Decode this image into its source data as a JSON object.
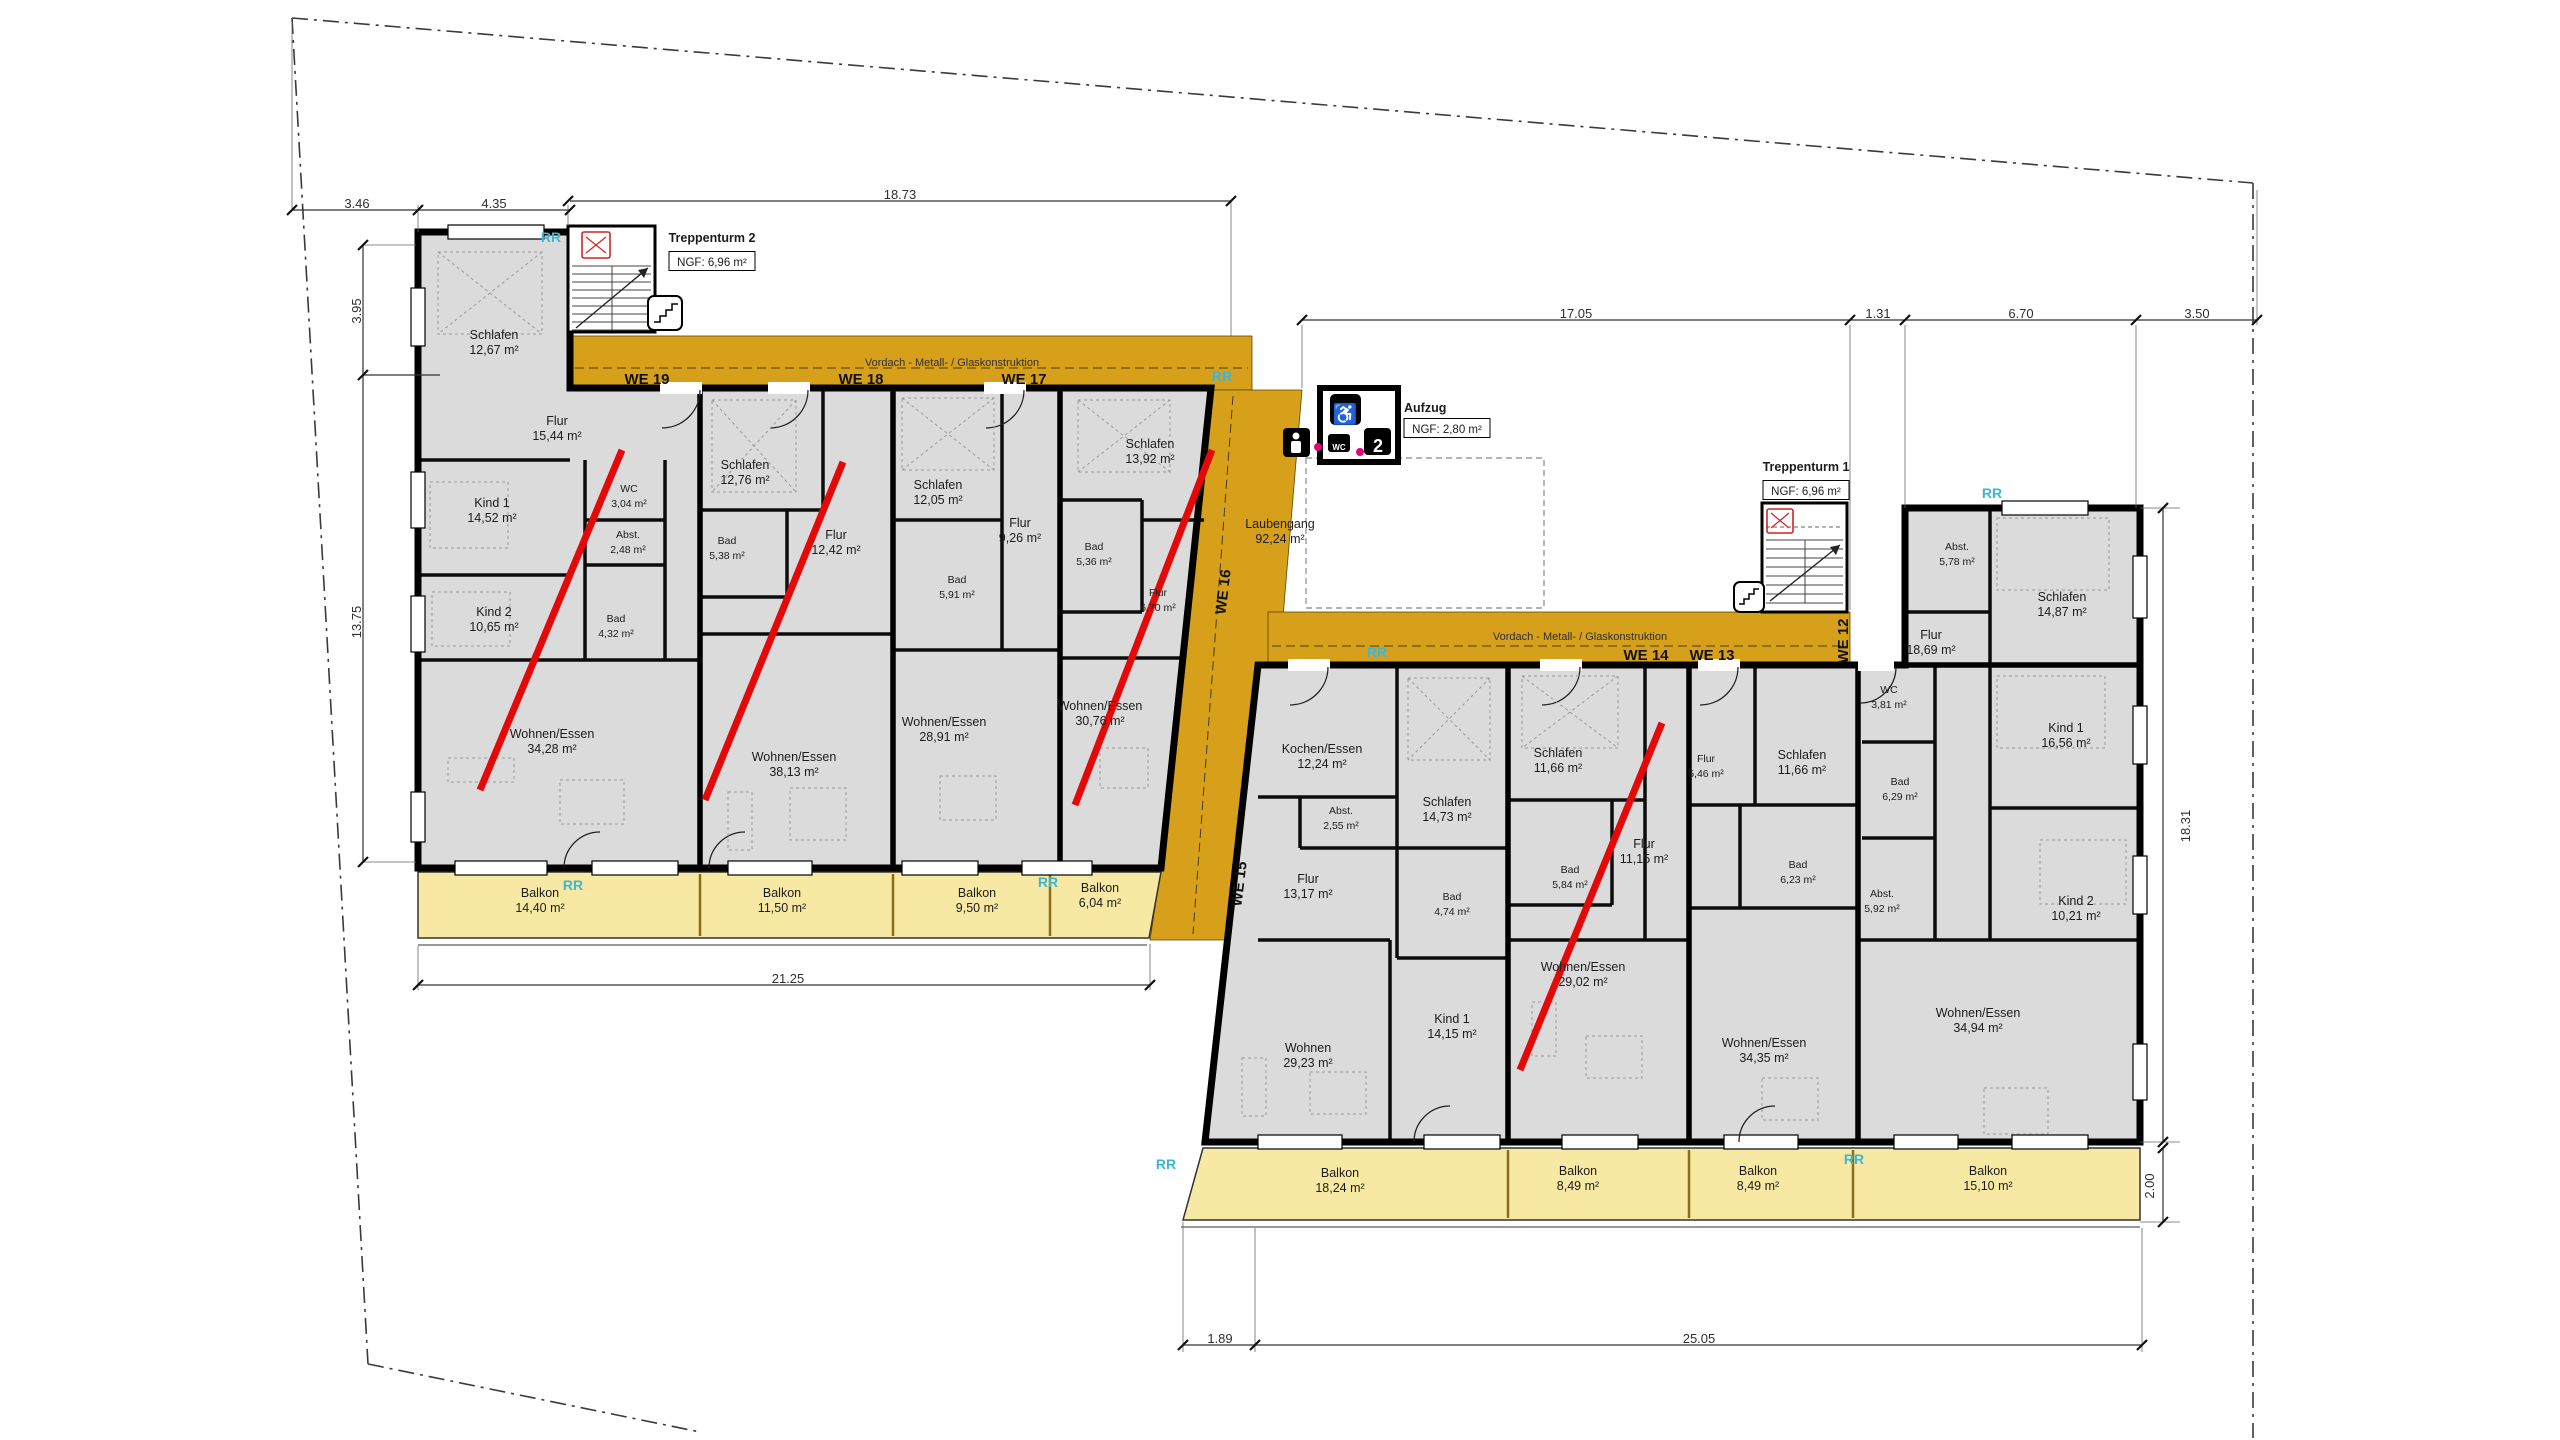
{
  "document": {
    "type": "architectural floor plan (Grundriss Obergeschoss)"
  },
  "colors": {
    "walkway_gold": "#D7A01B",
    "balcony_yellow": "#F7E8A3",
    "room_gray": "#DBDBDB",
    "marker_red": "#E50808",
    "rr_cyan": "#3AB7D8",
    "wall_black": "#000000"
  },
  "plan": {
    "labels": [
      {
        "k": "room",
        "unit": "WE 19",
        "t": [
          "Schlafen",
          "12,67 m²"
        ],
        "x": 494,
        "y": 341
      },
      {
        "k": "room",
        "unit": "WE 19",
        "t": [
          "Flur",
          "15,44 m²"
        ],
        "x": 557,
        "y": 427
      },
      {
        "k": "room",
        "unit": "WE 19",
        "t": [
          "Kind 1",
          "14,52 m²"
        ],
        "x": 492,
        "y": 509
      },
      {
        "k": "room small",
        "unit": "WE 19",
        "t": [
          "WC",
          "3,04 m²"
        ],
        "x": 629,
        "y": 494
      },
      {
        "k": "room small",
        "unit": "WE 19",
        "t": [
          "Abst.",
          "2,48 m²"
        ],
        "x": 628,
        "y": 540
      },
      {
        "k": "room",
        "unit": "WE 19",
        "t": [
          "Kind 2",
          "10,65 m²"
        ],
        "x": 494,
        "y": 618
      },
      {
        "k": "room small",
        "unit": "WE 19",
        "t": [
          "Bad",
          "4,32 m²"
        ],
        "x": 616,
        "y": 624
      },
      {
        "k": "room",
        "unit": "WE 19",
        "t": [
          "Wohnen/Essen",
          "34,28 m²"
        ],
        "x": 552,
        "y": 740
      },
      {
        "k": "room",
        "unit": "WE 19",
        "t": [
          "Balkon",
          "14,40 m²"
        ],
        "x": 540,
        "y": 899
      },
      {
        "k": "room",
        "unit": "WE 18",
        "t": [
          "Schlafen",
          "12,76 m²"
        ],
        "x": 745,
        "y": 471
      },
      {
        "k": "room small",
        "unit": "WE 18",
        "t": [
          "Bad",
          "5,38 m²"
        ],
        "x": 727,
        "y": 546
      },
      {
        "k": "room",
        "unit": "WE 18",
        "t": [
          "Flur",
          "12,42 m²"
        ],
        "x": 836,
        "y": 541
      },
      {
        "k": "room",
        "unit": "WE 18",
        "t": [
          "Wohnen/Essen",
          "38,13 m²"
        ],
        "x": 794,
        "y": 763
      },
      {
        "k": "room",
        "unit": "WE 18",
        "t": [
          "Balkon",
          "11,50 m²"
        ],
        "x": 782,
        "y": 899
      },
      {
        "k": "room",
        "unit": "WE 17",
        "t": [
          "Schlafen",
          "12,05 m²"
        ],
        "x": 938,
        "y": 491
      },
      {
        "k": "room",
        "unit": "WE 17",
        "t": [
          "Flur",
          "9,26 m²"
        ],
        "x": 1020,
        "y": 529
      },
      {
        "k": "room small",
        "unit": "WE 17",
        "t": [
          "Bad",
          "5,91 m²"
        ],
        "x": 957,
        "y": 585
      },
      {
        "k": "room",
        "unit": "WE 17",
        "t": [
          "Wohnen/Essen",
          "28,91 m²"
        ],
        "x": 944,
        "y": 728
      },
      {
        "k": "room",
        "unit": "WE 17",
        "t": [
          "Balkon",
          "9,50 m²"
        ],
        "x": 977,
        "y": 899
      },
      {
        "k": "room",
        "unit": "WE 16",
        "t": [
          "Schlafen",
          "13,92 m²"
        ],
        "x": 1150,
        "y": 450
      },
      {
        "k": "room small",
        "unit": "WE 16",
        "t": [
          "Bad",
          "5,36 m²"
        ],
        "x": 1094,
        "y": 552
      },
      {
        "k": "room small",
        "unit": "WE 16",
        "t": [
          "Flur",
          "6,70 m²"
        ],
        "x": 1158,
        "y": 598
      },
      {
        "k": "room",
        "unit": "WE 16",
        "t": [
          "Wohnen/Essen",
          "30,76 m²"
        ],
        "x": 1100,
        "y": 712
      },
      {
        "k": "room",
        "unit": "WE 16",
        "t": [
          "Balkon",
          "6,04 m²"
        ],
        "x": 1100,
        "y": 894
      },
      {
        "k": "room",
        "unit": "Laubengang",
        "t": [
          "Laubengang",
          "92,24 m²"
        ],
        "x": 1280,
        "y": 530
      },
      {
        "k": "room",
        "unit": "WE 15",
        "t": [
          "Kochen/Essen",
          "12,24 m²"
        ],
        "x": 1322,
        "y": 755
      },
      {
        "k": "room small",
        "unit": "WE 15",
        "t": [
          "Abst.",
          "2,55 m²"
        ],
        "x": 1341,
        "y": 816
      },
      {
        "k": "room",
        "unit": "WE 15",
        "t": [
          "Flur",
          "13,17 m²"
        ],
        "x": 1308,
        "y": 885
      },
      {
        "k": "room",
        "unit": "WE 15",
        "t": [
          "Schlafen",
          "14,73 m²"
        ],
        "x": 1447,
        "y": 808
      },
      {
        "k": "room small",
        "unit": "WE 15",
        "t": [
          "Bad",
          "4,74 m²"
        ],
        "x": 1452,
        "y": 902
      },
      {
        "k": "room",
        "unit": "WE 15",
        "t": [
          "Kind 1",
          "14,15 m²"
        ],
        "x": 1452,
        "y": 1025
      },
      {
        "k": "room",
        "unit": "WE 15",
        "t": [
          "Wohnen",
          "29,23 m²"
        ],
        "x": 1308,
        "y": 1054
      },
      {
        "k": "room",
        "unit": "WE 15",
        "t": [
          "Balkon",
          "18,24 m²"
        ],
        "x": 1340,
        "y": 1179
      },
      {
        "k": "room",
        "unit": "WE 14",
        "t": [
          "Schlafen",
          "11,66 m²"
        ],
        "x": 1558,
        "y": 759
      },
      {
        "k": "room small",
        "unit": "WE 14",
        "t": [
          "Bad",
          "5,84 m²"
        ],
        "x": 1570,
        "y": 875
      },
      {
        "k": "room",
        "unit": "WE 14",
        "t": [
          "Flur",
          "11,15 m²"
        ],
        "x": 1644,
        "y": 850
      },
      {
        "k": "room",
        "unit": "WE 14",
        "t": [
          "Wohnen/Essen",
          "29,02 m²"
        ],
        "x": 1583,
        "y": 973
      },
      {
        "k": "room",
        "unit": "WE 14",
        "t": [
          "Balkon",
          "8,49 m²"
        ],
        "x": 1578,
        "y": 1177
      },
      {
        "k": "room small",
        "unit": "WE 13",
        "t": [
          "Flur",
          "5,46 m²"
        ],
        "x": 1706,
        "y": 764
      },
      {
        "k": "room",
        "unit": "WE 13",
        "t": [
          "Schlafen",
          "11,66 m²"
        ],
        "x": 1802,
        "y": 761
      },
      {
        "k": "room small",
        "unit": "WE 13",
        "t": [
          "Bad",
          "6,23 m²"
        ],
        "x": 1798,
        "y": 870
      },
      {
        "k": "room",
        "unit": "WE 13",
        "t": [
          "Wohnen/Essen",
          "34,35 m²"
        ],
        "x": 1764,
        "y": 1049
      },
      {
        "k": "room",
        "unit": "WE 13",
        "t": [
          "Balkon",
          "8,49 m²"
        ],
        "x": 1758,
        "y": 1177
      },
      {
        "k": "room small",
        "unit": "WE 12",
        "t": [
          "WC",
          "3,81 m²"
        ],
        "x": 1889,
        "y": 695
      },
      {
        "k": "room small",
        "unit": "WE 12",
        "t": [
          "Bad",
          "6,29 m²"
        ],
        "x": 1900,
        "y": 787
      },
      {
        "k": "room small",
        "unit": "WE 12",
        "t": [
          "Abst.",
          "5,92 m²"
        ],
        "x": 1882,
        "y": 899
      },
      {
        "k": "room small",
        "unit": "WE 12",
        "t": [
          "Abst.",
          "5,78 m²"
        ],
        "x": 1957,
        "y": 552
      },
      {
        "k": "room",
        "unit": "WE 12",
        "t": [
          "Schlafen",
          "14,87 m²"
        ],
        "x": 2062,
        "y": 603
      },
      {
        "k": "room",
        "unit": "WE 12",
        "t": [
          "Flur",
          "18,69 m²"
        ],
        "x": 1931,
        "y": 641
      },
      {
        "k": "room",
        "unit": "WE 12",
        "t": [
          "Kind 1",
          "16,56 m²"
        ],
        "x": 2066,
        "y": 734
      },
      {
        "k": "room",
        "unit": "WE 12",
        "t": [
          "Kind 2",
          "10,21 m²"
        ],
        "x": 2076,
        "y": 907
      },
      {
        "k": "room",
        "unit": "WE 12",
        "t": [
          "Wohnen/Essen",
          "34,94 m²"
        ],
        "x": 1978,
        "y": 1019
      },
      {
        "k": "room",
        "unit": "WE 12",
        "t": [
          "Balkon",
          "15,10 m²"
        ],
        "x": 1988,
        "y": 1177
      },
      {
        "k": "we",
        "n": "unit-label",
        "t": [
          "WE 19"
        ],
        "x": 647,
        "y": 380
      },
      {
        "k": "we",
        "n": "unit-label",
        "t": [
          "WE 18"
        ],
        "x": 861,
        "y": 380
      },
      {
        "k": "we",
        "n": "unit-label",
        "t": [
          "WE 17"
        ],
        "x": 1024,
        "y": 380
      },
      {
        "k": "we",
        "n": "unit-label",
        "t": [
          "WE 16"
        ],
        "x": 1224,
        "y": 592,
        "r": -83
      },
      {
        "k": "we",
        "n": "unit-label",
        "t": [
          "WE 15"
        ],
        "x": 1240,
        "y": 884,
        "r": -83
      },
      {
        "k": "we",
        "n": "unit-label",
        "t": [
          "WE 14"
        ],
        "x": 1646,
        "y": 656
      },
      {
        "k": "we",
        "n": "unit-label",
        "t": [
          "WE 13"
        ],
        "x": 1712,
        "y": 656
      },
      {
        "k": "we",
        "n": "unit-label",
        "t": [
          "WE 12"
        ],
        "x": 1844,
        "y": 641,
        "r": -90
      },
      {
        "k": "rr",
        "n": "rr-marker",
        "t": [
          "RR"
        ],
        "x": 551,
        "y": 238
      },
      {
        "k": "rr",
        "n": "rr-marker",
        "t": [
          "RR"
        ],
        "x": 1222,
        "y": 377
      },
      {
        "k": "rr",
        "n": "rr-marker",
        "t": [
          "RR"
        ],
        "x": 573,
        "y": 886
      },
      {
        "k": "rr",
        "n": "rr-marker",
        "t": [
          "RR"
        ],
        "x": 1048,
        "y": 883
      },
      {
        "k": "rr",
        "n": "rr-marker",
        "t": [
          "RR"
        ],
        "x": 1377,
        "y": 653
      },
      {
        "k": "rr",
        "n": "rr-marker",
        "t": [
          "RR"
        ],
        "x": 1992,
        "y": 494
      },
      {
        "k": "rr",
        "n": "rr-marker",
        "t": [
          "RR"
        ],
        "x": 1166,
        "y": 1165
      },
      {
        "k": "rr",
        "n": "rr-marker",
        "t": [
          "RR"
        ],
        "x": 1854,
        "y": 1160
      },
      {
        "k": "head",
        "n": "stair-tower-2-title",
        "t": [
          "Treppenturm 2"
        ],
        "x": 712,
        "y": 238
      },
      {
        "k": "ngf",
        "n": "stair-tower-2-area",
        "t": [
          "NGF: 6,96 m²"
        ],
        "x": 712,
        "y": 262,
        "box": [
          86,
          19
        ]
      },
      {
        "k": "head",
        "n": "stair-tower-1-title",
        "t": [
          "Treppenturm 1"
        ],
        "x": 1806,
        "y": 467
      },
      {
        "k": "ngf",
        "n": "stair-tower-1-area",
        "t": [
          "NGF: 6,96 m²"
        ],
        "x": 1806,
        "y": 491,
        "box": [
          86,
          19
        ]
      },
      {
        "k": "head",
        "n": "elevator-title",
        "t": [
          "Aufzug"
        ],
        "x": 1404,
        "y": 408,
        "a": "start"
      },
      {
        "k": "ngf",
        "n": "elevator-area",
        "t": [
          "NGF: 2,80 m²"
        ],
        "x": 1447,
        "y": 429,
        "box": [
          86,
          19
        ]
      },
      {
        "k": "vord",
        "n": "canopy-label",
        "t": [
          "Vordach - Metall- / Glaskonstruktion"
        ],
        "x": 952,
        "y": 362
      },
      {
        "k": "vord",
        "n": "canopy-label",
        "t": [
          "Vordach - Metall- / Glaskonstruktion"
        ],
        "x": 1580,
        "y": 636
      },
      {
        "k": "dim",
        "n": "dimension-label",
        "t": [
          "3.46"
        ],
        "x": 357,
        "y": 204
      },
      {
        "k": "dim",
        "n": "dimension-label",
        "t": [
          "4.35"
        ],
        "x": 494,
        "y": 204
      },
      {
        "k": "dim",
        "n": "dimension-label",
        "t": [
          "18.73"
        ],
        "x": 900,
        "y": 195
      },
      {
        "k": "dim",
        "n": "dimension-label",
        "t": [
          "3.95"
        ],
        "x": 357,
        "y": 311,
        "r": -90
      },
      {
        "k": "dim",
        "n": "dimension-label",
        "t": [
          "13.75"
        ],
        "x": 357,
        "y": 622,
        "r": -90
      },
      {
        "k": "dim",
        "n": "dimension-label",
        "t": [
          "21.25"
        ],
        "x": 788,
        "y": 979
      },
      {
        "k": "dim",
        "n": "dimension-label",
        "t": [
          "17.05"
        ],
        "x": 1576,
        "y": 314
      },
      {
        "k": "dim",
        "n": "dimension-label",
        "t": [
          "1.31"
        ],
        "x": 1878,
        "y": 314
      },
      {
        "k": "dim",
        "n": "dimension-label",
        "t": [
          "6.70"
        ],
        "x": 2021,
        "y": 314
      },
      {
        "k": "dim",
        "n": "dimension-label",
        "t": [
          "3.50"
        ],
        "x": 2197,
        "y": 314
      },
      {
        "k": "dim",
        "n": "dimension-label",
        "t": [
          "18.31"
        ],
        "x": 2186,
        "y": 826,
        "r": -90
      },
      {
        "k": "dim",
        "n": "dimension-label",
        "t": [
          "2.00"
        ],
        "x": 2150,
        "y": 1186,
        "r": -90
      },
      {
        "k": "dim",
        "n": "dimension-label",
        "t": [
          "1.89"
        ],
        "x": 1220,
        "y": 1339
      },
      {
        "k": "dim",
        "n": "dimension-label",
        "t": [
          "25.05"
        ],
        "x": 1699,
        "y": 1339
      },
      {
        "k": "icon",
        "n": "wheelchair-icon",
        "t": [
          "♿"
        ],
        "x": 1345,
        "y": 417
      },
      {
        "k": "icon2",
        "n": "elevator-level-2-icon",
        "t": [
          "2"
        ],
        "x": 1378,
        "y": 448
      },
      {
        "k": "icon3",
        "n": "wc-icon",
        "t": [
          "WC"
        ],
        "x": 1339,
        "y": 446
      }
    ]
  }
}
